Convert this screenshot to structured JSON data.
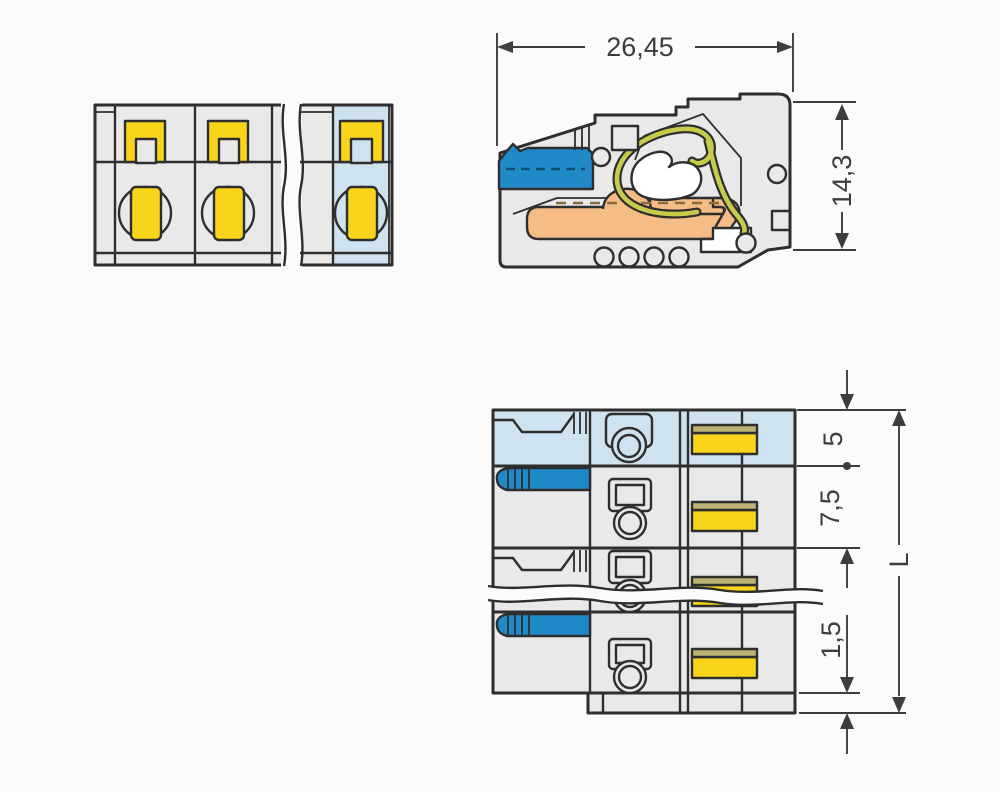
{
  "dimensions": {
    "overall_width": "26,45",
    "overall_height": "14,3",
    "first_pitch": "5",
    "pole_pitch": "7,5",
    "bottom_offset": "1,5",
    "total_length": "L"
  },
  "colors": {
    "background": "#fbfbfb",
    "housing": "#e9e9e9",
    "outline": "#2e2e2e",
    "dimension": "#3d3d3d",
    "highlight_blue": "#cfe2ef",
    "lever_blue": "#2089c8",
    "button_yellow": "#f8d41a",
    "marker_tan": "#bfb275",
    "contact_orange": "#f5bc85",
    "spring_green": "#c6cc4a"
  }
}
